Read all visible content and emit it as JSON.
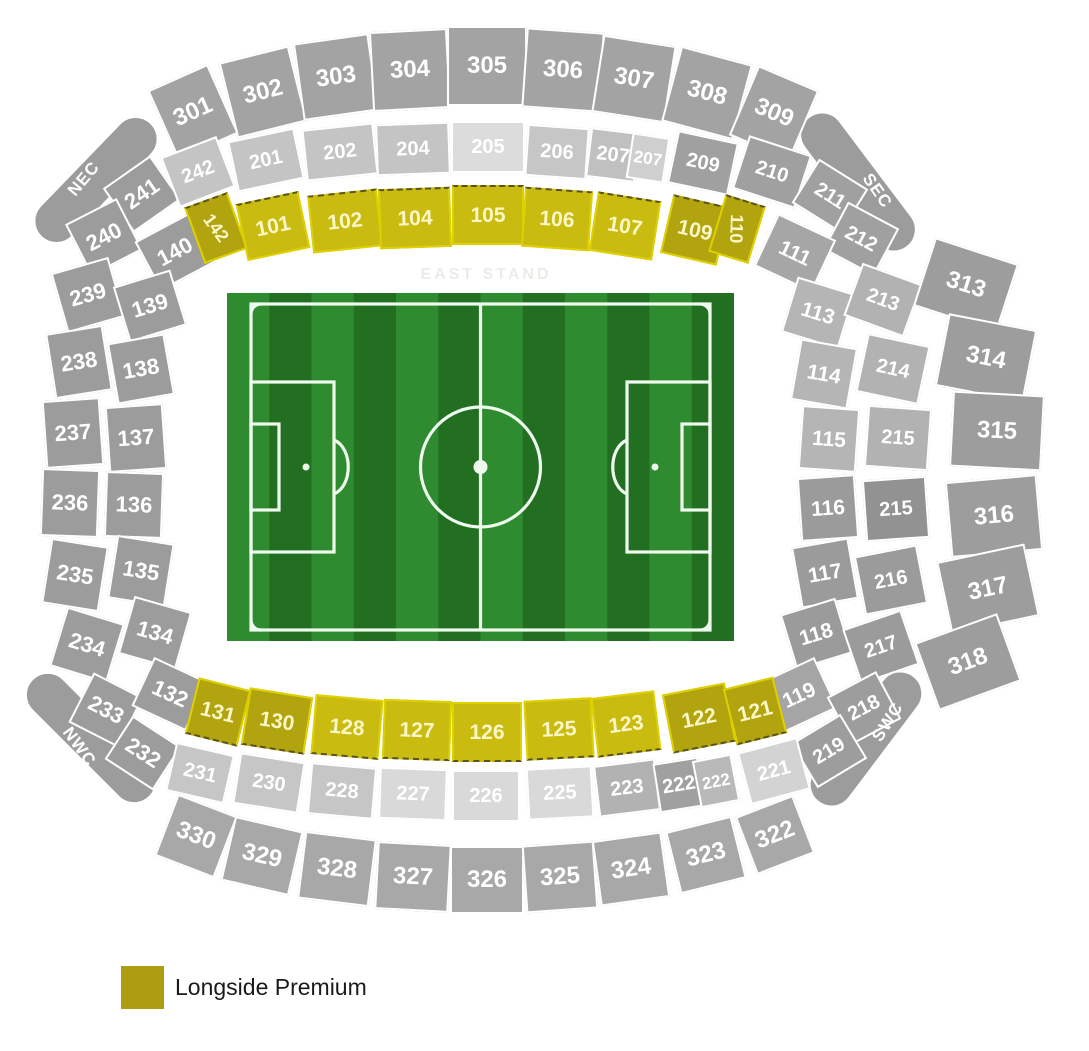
{
  "legend": {
    "items": [
      {
        "label": "Longside Premium",
        "color": "#ad9d12"
      }
    ]
  },
  "colors": {
    "ring300_top": "#a3a3a3",
    "ring300_bottom": "#a8a8a8",
    "ring300_right": "#9d9d9d",
    "outer_gray": "#9c9c9c",
    "light_gray": "#c4c4c4",
    "lighter_gray": "#dcdcdc",
    "mid_gray": "#b2b2b2",
    "dark_gray": "#9b9b9b",
    "yellow_bright": "#cabb11",
    "yellow_dark": "#b1a40e",
    "yellow_text": "#fcf7c8"
  },
  "pitch": {
    "x": 227,
    "y": 293,
    "w": 507,
    "h": 348,
    "stripe_light": "#2f8b2f",
    "stripe_dark": "#226f22",
    "line_color": "#eefaee"
  },
  "floating_labels": [
    {
      "id": "corner-label-nec",
      "text": "NEC",
      "x": 84,
      "y": 179,
      "rot": -50,
      "size": 17,
      "color": "#ffffff",
      "ls": 1
    },
    {
      "id": "corner-label-sec",
      "text": "SEC",
      "x": 877,
      "y": 191,
      "rot": 55,
      "size": 17,
      "color": "#ffffff",
      "ls": 1
    },
    {
      "id": "corner-label-swc",
      "text": "SWC",
      "x": 888,
      "y": 722,
      "rot": -58,
      "size": 17,
      "color": "#ffffff",
      "ls": 1
    },
    {
      "id": "corner-label-nwc",
      "text": "NWC",
      "x": 79,
      "y": 747,
      "rot": 54,
      "size": 17,
      "color": "#ffffff",
      "ls": 1
    },
    {
      "id": "east-stand-label",
      "text": "EAST STAND",
      "x": 486,
      "y": 275,
      "rot": 0,
      "size": 16,
      "color": "#ebebe7",
      "ls": 3
    }
  ],
  "sections": [
    {
      "id": "nec-band",
      "n": "",
      "x": 96,
      "y": 180,
      "w": 160,
      "h": 46,
      "r": -46,
      "f": "#9c9c9c",
      "fs": 16,
      "cls": "band"
    },
    {
      "id": "sec-band",
      "n": "",
      "x": 858,
      "y": 182,
      "w": 165,
      "h": 46,
      "r": 53,
      "f": "#9c9c9c",
      "fs": 16,
      "cls": "band"
    },
    {
      "id": "swc-band",
      "n": "",
      "x": 866,
      "y": 739,
      "w": 160,
      "h": 46,
      "r": -53,
      "f": "#9c9c9c",
      "fs": 16,
      "cls": "band"
    },
    {
      "id": "nwc-band",
      "n": "",
      "x": 91,
      "y": 738,
      "w": 168,
      "h": 46,
      "r": 45,
      "f": "#9c9c9c",
      "fs": 16,
      "cls": "band"
    },
    {
      "n": "301",
      "x": 193,
      "y": 112,
      "w": 66,
      "h": 76,
      "r": -24,
      "f": "#a3a3a3",
      "fs": 24
    },
    {
      "n": "302",
      "x": 263,
      "y": 92,
      "w": 72,
      "h": 78,
      "r": -14,
      "f": "#a3a3a3",
      "fs": 24
    },
    {
      "n": "303",
      "x": 336,
      "y": 77,
      "w": 76,
      "h": 78,
      "r": -8,
      "f": "#a3a3a3",
      "fs": 24
    },
    {
      "n": "304",
      "x": 410,
      "y": 70,
      "w": 78,
      "h": 80,
      "r": -3,
      "f": "#a3a3a3",
      "fs": 24
    },
    {
      "n": "305",
      "x": 487,
      "y": 66,
      "w": 80,
      "h": 80,
      "r": 0,
      "f": "#a3a3a3",
      "fs": 24
    },
    {
      "n": "306",
      "x": 563,
      "y": 70,
      "w": 78,
      "h": 80,
      "r": 4,
      "f": "#a3a3a3",
      "fs": 24
    },
    {
      "n": "307",
      "x": 634,
      "y": 79,
      "w": 74,
      "h": 78,
      "r": 9,
      "f": "#a3a3a3",
      "fs": 24
    },
    {
      "n": "308",
      "x": 707,
      "y": 93,
      "w": 74,
      "h": 78,
      "r": 15,
      "f": "#a3a3a3",
      "fs": 24
    },
    {
      "n": "309",
      "x": 774,
      "y": 113,
      "w": 66,
      "h": 76,
      "r": 23,
      "f": "#a3a3a3",
      "fs": 24
    },
    {
      "n": "241",
      "x": 142,
      "y": 194,
      "w": 58,
      "h": 54,
      "r": -35,
      "f": "#9c9c9c",
      "fs": 22
    },
    {
      "n": "240",
      "x": 104,
      "y": 237,
      "w": 58,
      "h": 58,
      "r": -27,
      "f": "#9c9c9c",
      "fs": 22
    },
    {
      "n": "239",
      "x": 88,
      "y": 295,
      "w": 60,
      "h": 62,
      "r": -16,
      "f": "#9c9c9c",
      "fs": 22
    },
    {
      "n": "238",
      "x": 79,
      "y": 362,
      "w": 58,
      "h": 66,
      "r": -9,
      "f": "#9c9c9c",
      "fs": 22
    },
    {
      "n": "237",
      "x": 73,
      "y": 433,
      "w": 58,
      "h": 68,
      "r": -4,
      "f": "#9c9c9c",
      "fs": 22
    },
    {
      "n": "236",
      "x": 70,
      "y": 503,
      "w": 58,
      "h": 68,
      "r": 2,
      "f": "#9c9c9c",
      "fs": 22
    },
    {
      "n": "235",
      "x": 75,
      "y": 575,
      "w": 58,
      "h": 66,
      "r": 9,
      "f": "#9c9c9c",
      "fs": 22
    },
    {
      "n": "234",
      "x": 87,
      "y": 645,
      "w": 60,
      "h": 62,
      "r": 17,
      "f": "#9c9c9c",
      "fs": 22
    },
    {
      "n": "233",
      "x": 106,
      "y": 710,
      "w": 56,
      "h": 56,
      "r": 27,
      "f": "#9c9c9c",
      "fs": 22
    },
    {
      "n": "232",
      "x": 143,
      "y": 753,
      "w": 58,
      "h": 52,
      "r": 33,
      "f": "#9c9c9c",
      "fs": 22
    },
    {
      "n": "140",
      "x": 175,
      "y": 252,
      "w": 62,
      "h": 56,
      "r": -28,
      "f": "#9c9c9c",
      "fs": 22
    },
    {
      "n": "139",
      "x": 150,
      "y": 306,
      "w": 60,
      "h": 58,
      "r": -17,
      "f": "#9c9c9c",
      "fs": 22
    },
    {
      "n": "138",
      "x": 141,
      "y": 369,
      "w": 58,
      "h": 62,
      "r": -10,
      "f": "#9c9c9c",
      "fs": 22
    },
    {
      "n": "137",
      "x": 136,
      "y": 438,
      "w": 58,
      "h": 66,
      "r": -4,
      "f": "#9c9c9c",
      "fs": 22
    },
    {
      "n": "136",
      "x": 134,
      "y": 505,
      "w": 58,
      "h": 66,
      "r": 2,
      "f": "#9c9c9c",
      "fs": 22
    },
    {
      "n": "135",
      "x": 141,
      "y": 571,
      "w": 58,
      "h": 64,
      "r": 9,
      "f": "#9c9c9c",
      "fs": 22
    },
    {
      "n": "134",
      "x": 155,
      "y": 633,
      "w": 60,
      "h": 60,
      "r": 16,
      "f": "#9c9c9c",
      "fs": 22
    },
    {
      "n": "132",
      "x": 170,
      "y": 694,
      "w": 60,
      "h": 54,
      "r": 25,
      "f": "#9c9c9c",
      "fs": 22
    },
    {
      "n": "242",
      "x": 198,
      "y": 172,
      "w": 60,
      "h": 54,
      "r": -21,
      "f": "#c4c4c4",
      "fs": 20
    },
    {
      "n": "201",
      "x": 266,
      "y": 160,
      "w": 68,
      "h": 52,
      "r": -12,
      "f": "#c4c4c4",
      "fs": 20
    },
    {
      "n": "202",
      "x": 340,
      "y": 152,
      "w": 72,
      "h": 52,
      "r": -6,
      "f": "#c4c4c4",
      "fs": 20
    },
    {
      "n": "204",
      "x": 413,
      "y": 149,
      "w": 74,
      "h": 52,
      "r": -2,
      "f": "#c4c4c4",
      "fs": 20
    },
    {
      "n": "205",
      "x": 488,
      "y": 147,
      "w": 74,
      "h": 52,
      "r": 0,
      "f": "#dcdcdc",
      "fs": 20
    },
    {
      "n": "206",
      "x": 557,
      "y": 152,
      "w": 62,
      "h": 52,
      "r": 4,
      "f": "#c6c6c6",
      "fs": 20
    },
    {
      "n": "207",
      "x": 613,
      "y": 155,
      "w": 50,
      "h": 50,
      "r": 7,
      "f": "#c0c0c0",
      "fs": 20
    },
    {
      "n": "207",
      "x": 648,
      "y": 158,
      "w": 38,
      "h": 46,
      "r": 9,
      "f": "#cfcfcf",
      "fs": 17
    },
    {
      "n": "209",
      "x": 703,
      "y": 163,
      "w": 62,
      "h": 54,
      "r": 12,
      "f": "#a0a0a0",
      "fs": 20
    },
    {
      "n": "210",
      "x": 772,
      "y": 172,
      "w": 66,
      "h": 56,
      "r": 18,
      "f": "#a0a0a0",
      "fs": 20
    },
    {
      "n": "211",
      "x": 830,
      "y": 196,
      "w": 58,
      "h": 52,
      "r": 32,
      "f": "#a0a0a0",
      "fs": 20
    },
    {
      "n": "212",
      "x": 861,
      "y": 239,
      "w": 58,
      "h": 54,
      "r": 28,
      "f": "#a0a0a0",
      "fs": 20
    },
    {
      "n": "111",
      "x": 795,
      "y": 253,
      "w": 64,
      "h": 58,
      "r": 25,
      "f": "#a6a6a6",
      "fs": 21
    },
    {
      "n": "113",
      "x": 818,
      "y": 313,
      "w": 60,
      "h": 58,
      "r": 17,
      "f": "#b5b5b5",
      "fs": 21
    },
    {
      "n": "114",
      "x": 824,
      "y": 374,
      "w": 58,
      "h": 62,
      "r": 10,
      "f": "#b5b5b5",
      "fs": 21
    },
    {
      "n": "115",
      "x": 829,
      "y": 439,
      "w": 58,
      "h": 64,
      "r": 4,
      "f": "#b5b5b5",
      "fs": 21
    },
    {
      "n": "116",
      "x": 828,
      "y": 508,
      "w": 58,
      "h": 64,
      "r": -4,
      "f": "#9b9b9b",
      "fs": 21
    },
    {
      "n": "117",
      "x": 825,
      "y": 573,
      "w": 58,
      "h": 62,
      "r": -10,
      "f": "#9b9b9b",
      "fs": 21
    },
    {
      "n": "118",
      "x": 816,
      "y": 634,
      "w": 58,
      "h": 58,
      "r": -17,
      "f": "#9b9b9b",
      "fs": 21
    },
    {
      "n": "119",
      "x": 799,
      "y": 695,
      "w": 60,
      "h": 56,
      "r": -25,
      "f": "#a5a5a5",
      "fs": 21
    },
    {
      "n": "213",
      "x": 883,
      "y": 300,
      "w": 64,
      "h": 56,
      "r": 20,
      "f": "#b2b2b2",
      "fs": 20
    },
    {
      "n": "214",
      "x": 893,
      "y": 369,
      "w": 64,
      "h": 60,
      "r": 12,
      "f": "#b2b2b2",
      "fs": 20
    },
    {
      "n": "215",
      "x": 898,
      "y": 438,
      "w": 64,
      "h": 62,
      "r": 4,
      "f": "#b2b2b2",
      "fs": 20
    },
    {
      "n": "215",
      "x": 896,
      "y": 509,
      "w": 64,
      "h": 62,
      "r": -4,
      "f": "#929292",
      "fs": 20
    },
    {
      "n": "216",
      "x": 891,
      "y": 580,
      "w": 64,
      "h": 60,
      "r": -11,
      "f": "#9b9b9b",
      "fs": 20
    },
    {
      "n": "217",
      "x": 881,
      "y": 647,
      "w": 62,
      "h": 58,
      "r": -19,
      "f": "#9b9b9b",
      "fs": 20
    },
    {
      "n": "218",
      "x": 864,
      "y": 708,
      "w": 56,
      "h": 54,
      "r": -28,
      "f": "#9d9d9d",
      "fs": 20
    },
    {
      "n": "219",
      "x": 829,
      "y": 751,
      "w": 58,
      "h": 52,
      "r": -31,
      "f": "#9d9d9d",
      "fs": 20
    },
    {
      "n": "313",
      "x": 966,
      "y": 285,
      "w": 88,
      "h": 72,
      "r": 18,
      "f": "#9d9d9d",
      "fs": 24
    },
    {
      "n": "314",
      "x": 986,
      "y": 358,
      "w": 90,
      "h": 74,
      "r": 11,
      "f": "#9d9d9d",
      "fs": 24
    },
    {
      "n": "315",
      "x": 997,
      "y": 431,
      "w": 92,
      "h": 76,
      "r": 3,
      "f": "#9d9d9d",
      "fs": 24
    },
    {
      "n": "316",
      "x": 994,
      "y": 516,
      "w": 92,
      "h": 76,
      "r": -5,
      "f": "#9d9d9d",
      "fs": 24
    },
    {
      "n": "317",
      "x": 988,
      "y": 589,
      "w": 90,
      "h": 74,
      "r": -12,
      "f": "#9d9d9d",
      "fs": 24
    },
    {
      "n": "318",
      "x": 968,
      "y": 662,
      "w": 88,
      "h": 72,
      "r": -20,
      "f": "#9d9d9d",
      "fs": 24
    },
    {
      "n": "231",
      "x": 200,
      "y": 773,
      "w": 60,
      "h": 50,
      "r": 13,
      "f": "#c6c6c6",
      "fs": 20
    },
    {
      "n": "230",
      "x": 269,
      "y": 783,
      "w": 66,
      "h": 52,
      "r": 9,
      "f": "#c6c6c6",
      "fs": 20
    },
    {
      "n": "228",
      "x": 342,
      "y": 791,
      "w": 66,
      "h": 52,
      "r": 5,
      "f": "#c6c6c6",
      "fs": 20
    },
    {
      "n": "227",
      "x": 413,
      "y": 794,
      "w": 68,
      "h": 52,
      "r": 2,
      "f": "#d9d9d9",
      "fs": 20
    },
    {
      "n": "226",
      "x": 486,
      "y": 796,
      "w": 68,
      "h": 52,
      "r": 0,
      "f": "#d9d9d9",
      "fs": 20
    },
    {
      "n": "225",
      "x": 560,
      "y": 793,
      "w": 66,
      "h": 52,
      "r": -3,
      "f": "#d9d9d9",
      "fs": 20
    },
    {
      "n": "223",
      "x": 627,
      "y": 788,
      "w": 62,
      "h": 52,
      "r": -7,
      "f": "#b2b2b2",
      "fs": 20
    },
    {
      "n": "222",
      "x": 679,
      "y": 785,
      "w": 46,
      "h": 50,
      "r": -9,
      "f": "#a0a0a0",
      "fs": 20
    },
    {
      "n": "222",
      "x": 716,
      "y": 781,
      "w": 40,
      "h": 48,
      "r": -11,
      "f": "#b9b9b9",
      "fs": 17
    },
    {
      "n": "221",
      "x": 774,
      "y": 771,
      "w": 62,
      "h": 54,
      "r": -15,
      "f": "#d3d3d3",
      "fs": 20
    },
    {
      "n": "330",
      "x": 196,
      "y": 836,
      "w": 64,
      "h": 66,
      "r": 21,
      "f": "#a8a8a8",
      "fs": 24
    },
    {
      "n": "329",
      "x": 262,
      "y": 856,
      "w": 70,
      "h": 66,
      "r": 13,
      "f": "#a8a8a8",
      "fs": 24
    },
    {
      "n": "328",
      "x": 337,
      "y": 869,
      "w": 72,
      "h": 68,
      "r": 7,
      "f": "#a8a8a8",
      "fs": 24
    },
    {
      "n": "327",
      "x": 413,
      "y": 877,
      "w": 74,
      "h": 68,
      "r": 3,
      "f": "#a8a8a8",
      "fs": 24
    },
    {
      "n": "326",
      "x": 487,
      "y": 880,
      "w": 74,
      "h": 68,
      "r": 0,
      "f": "#a8a8a8",
      "fs": 24
    },
    {
      "n": "325",
      "x": 560,
      "y": 877,
      "w": 72,
      "h": 68,
      "r": -4,
      "f": "#a8a8a8",
      "fs": 24
    },
    {
      "n": "324",
      "x": 631,
      "y": 869,
      "w": 70,
      "h": 66,
      "r": -8,
      "f": "#a8a8a8",
      "fs": 24
    },
    {
      "n": "323",
      "x": 706,
      "y": 855,
      "w": 68,
      "h": 64,
      "r": -14,
      "f": "#a8a8a8",
      "fs": 24
    },
    {
      "n": "322",
      "x": 775,
      "y": 835,
      "w": 62,
      "h": 62,
      "r": -21,
      "f": "#a8a8a8",
      "fs": 24
    },
    {
      "n": "142",
      "x": 216,
      "y": 228,
      "w": 46,
      "h": 60,
      "r": -20,
      "f": "#b1a40e",
      "fs": 18,
      "tc": "#fcf7c8",
      "tr": 74,
      "cls": "yellow",
      "dash": "top"
    },
    {
      "n": "101",
      "x": 273,
      "y": 226,
      "w": 64,
      "h": 58,
      "r": -12,
      "f": "#cabb11",
      "fs": 21,
      "tc": "#fcf7c8",
      "cls": "yellow",
      "dash": "top"
    },
    {
      "n": "102",
      "x": 345,
      "y": 221,
      "w": 70,
      "h": 58,
      "r": -6,
      "f": "#cabb11",
      "fs": 21,
      "tc": "#fcf7c8",
      "cls": "yellow",
      "dash": "top"
    },
    {
      "n": "104",
      "x": 415,
      "y": 218,
      "w": 72,
      "h": 60,
      "r": -2,
      "f": "#cabb11",
      "fs": 21,
      "tc": "#fcf7c8",
      "cls": "yellow",
      "dash": "top"
    },
    {
      "n": "105",
      "x": 488,
      "y": 215,
      "w": 72,
      "h": 60,
      "r": 0,
      "f": "#cabb11",
      "fs": 21,
      "tc": "#fcf7c8",
      "cls": "yellow",
      "dash": "top"
    },
    {
      "n": "106",
      "x": 557,
      "y": 219,
      "w": 68,
      "h": 60,
      "r": 4,
      "f": "#cabb11",
      "fs": 21,
      "tc": "#fcf7c8",
      "cls": "yellow",
      "dash": "top"
    },
    {
      "n": "107",
      "x": 625,
      "y": 226,
      "w": 64,
      "h": 60,
      "r": 9,
      "f": "#cabb11",
      "fs": 21,
      "tc": "#fcf7c8",
      "cls": "yellow",
      "dash": "top"
    },
    {
      "n": "109",
      "x": 695,
      "y": 230,
      "w": 58,
      "h": 60,
      "r": 13,
      "f": "#b1a40e",
      "fs": 21,
      "tc": "#fcf7c8",
      "cls": "yellow",
      "dash": "top"
    },
    {
      "n": "110",
      "x": 737,
      "y": 229,
      "w": 42,
      "h": 60,
      "r": 17,
      "f": "#b1a40e",
      "fs": 18,
      "tc": "#fcf7c8",
      "tr": 75,
      "cls": "yellow",
      "dash": "top"
    },
    {
      "n": "131",
      "x": 218,
      "y": 712,
      "w": 54,
      "h": 58,
      "r": 14,
      "f": "#b1a40e",
      "fs": 21,
      "tc": "#fcf7c8",
      "cls": "yellow",
      "dash": "bottom"
    },
    {
      "n": "130",
      "x": 277,
      "y": 721,
      "w": 64,
      "h": 58,
      "r": 9,
      "f": "#b1a40e",
      "fs": 21,
      "tc": "#fcf7c8",
      "cls": "yellow",
      "dash": "bottom"
    },
    {
      "n": "128",
      "x": 347,
      "y": 727,
      "w": 68,
      "h": 60,
      "r": 5,
      "f": "#cabb11",
      "fs": 21,
      "tc": "#fcf7c8",
      "cls": "yellow",
      "dash": "bottom"
    },
    {
      "n": "127",
      "x": 417,
      "y": 730,
      "w": 68,
      "h": 60,
      "r": 2,
      "f": "#cabb11",
      "fs": 21,
      "tc": "#fcf7c8",
      "cls": "yellow",
      "dash": "bottom"
    },
    {
      "n": "126",
      "x": 487,
      "y": 732,
      "w": 70,
      "h": 60,
      "r": 0,
      "f": "#cabb11",
      "fs": 21,
      "tc": "#fcf7c8",
      "cls": "yellow",
      "dash": "bottom"
    },
    {
      "n": "125",
      "x": 559,
      "y": 729,
      "w": 68,
      "h": 60,
      "r": -3,
      "f": "#cabb11",
      "fs": 21,
      "tc": "#fcf7c8",
      "cls": "yellow",
      "dash": "bottom"
    },
    {
      "n": "123",
      "x": 626,
      "y": 724,
      "w": 64,
      "h": 60,
      "r": -7,
      "f": "#cabb11",
      "fs": 21,
      "tc": "#fcf7c8",
      "cls": "yellow",
      "dash": "bottom"
    },
    {
      "n": "122",
      "x": 699,
      "y": 718,
      "w": 64,
      "h": 60,
      "r": -11,
      "f": "#b1a40e",
      "fs": 21,
      "tc": "#fcf7c8",
      "cls": "yellow",
      "dash": "bottom"
    },
    {
      "n": "121",
      "x": 755,
      "y": 711,
      "w": 52,
      "h": 58,
      "r": -14,
      "f": "#b1a40e",
      "fs": 21,
      "tc": "#fcf7c8",
      "cls": "yellow",
      "dash": "bottom"
    }
  ]
}
